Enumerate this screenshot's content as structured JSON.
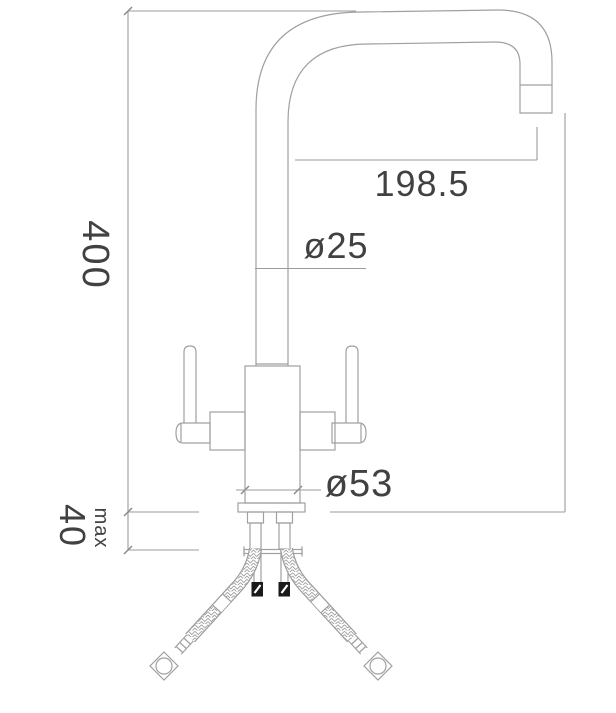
{
  "drawing": {
    "labels": {
      "total_height": "400",
      "counter_max_thickness": "40",
      "counter_max_qualifier": "max",
      "spout_reach": "198.5",
      "spout_tube_diameter": "ø25",
      "body_base_diameter": "ø53"
    },
    "colors": {
      "background": "#ffffff",
      "outline": "#a0a0a0",
      "dimension_line": "#9b9b9b",
      "label_text": "#414141",
      "solid_fitting": "#1a1a1a"
    }
  }
}
